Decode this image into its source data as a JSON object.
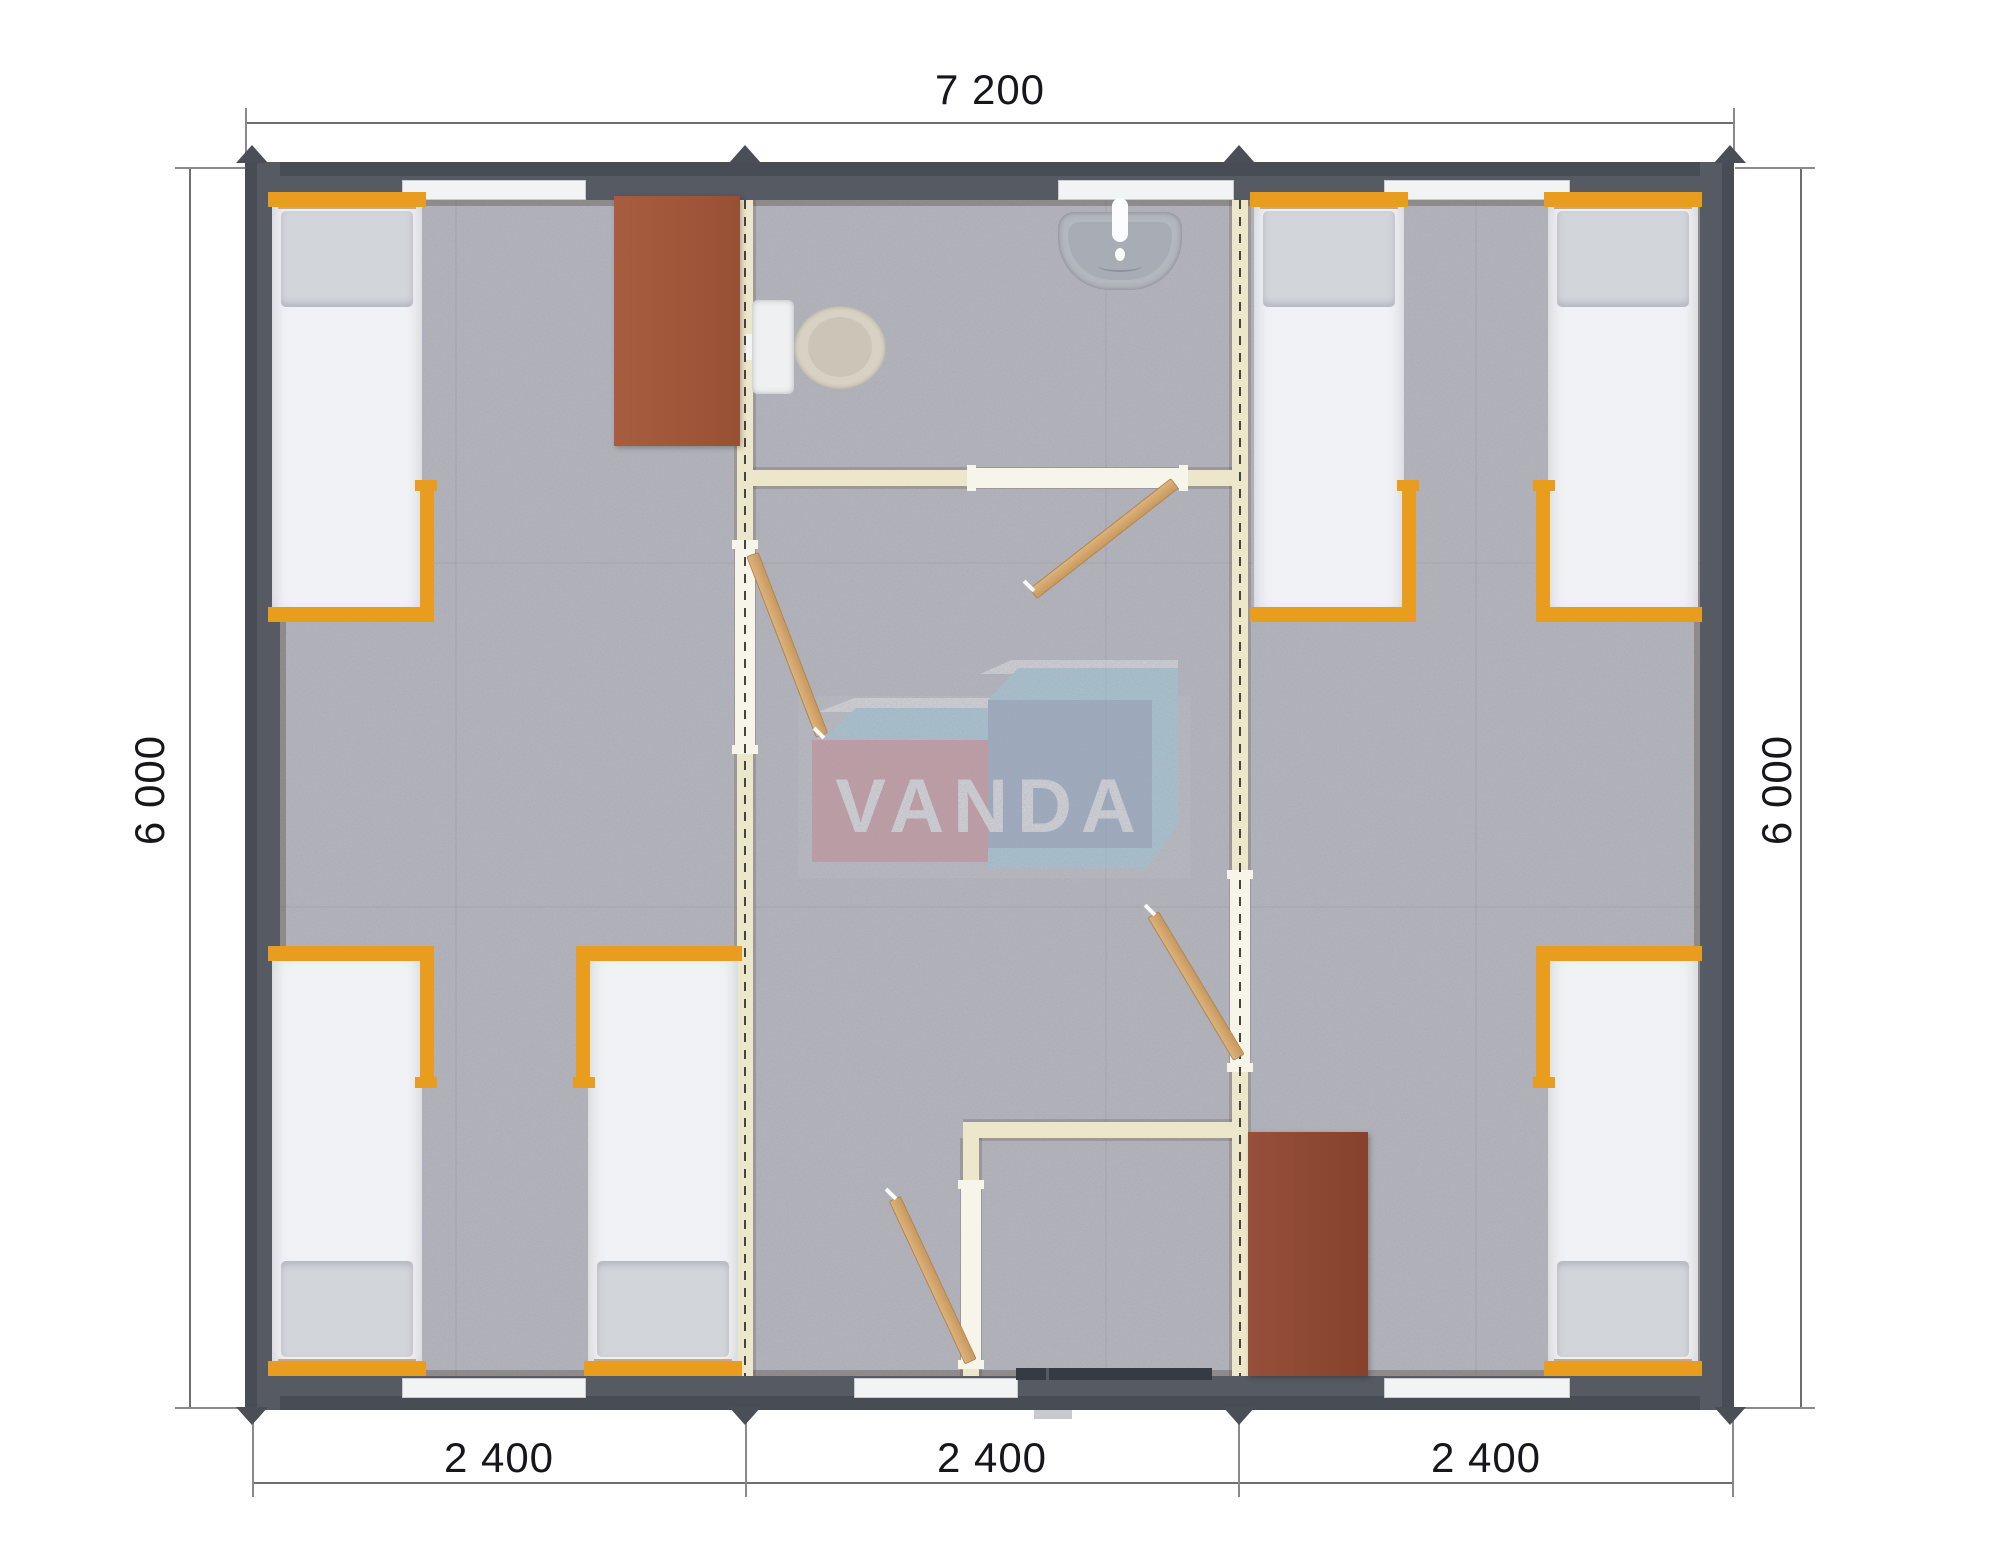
{
  "document": {
    "type": "floor-plan",
    "description": "Top-down render of a three-module portable building with bedrooms, sanitary room, hallway and entrance vestibule"
  },
  "dimensions": {
    "top": "7 200",
    "left": "6 000",
    "right": "6 000",
    "bottom": [
      "2 400",
      "2 400",
      "2 400"
    ]
  },
  "watermark": {
    "text": "VANDA"
  },
  "colors": {
    "outer_wall": "#555a63",
    "roof_edge": "#474c55",
    "floor": "#a6a7b0",
    "partition": "#ece6cb",
    "bed_frame_orange": "#e89d1e",
    "mattress": "#f1f2f5",
    "pillow": "#d2d5da",
    "desk_brown": "#a0583b",
    "wardrobe_brown": "#8e4730",
    "door_wood": "#d1a46d",
    "logo_red": "#d4858e",
    "logo_blue": "#8aa5c6",
    "logo_cyan": "#9ed2e6",
    "dimension_text": "#17171b"
  }
}
